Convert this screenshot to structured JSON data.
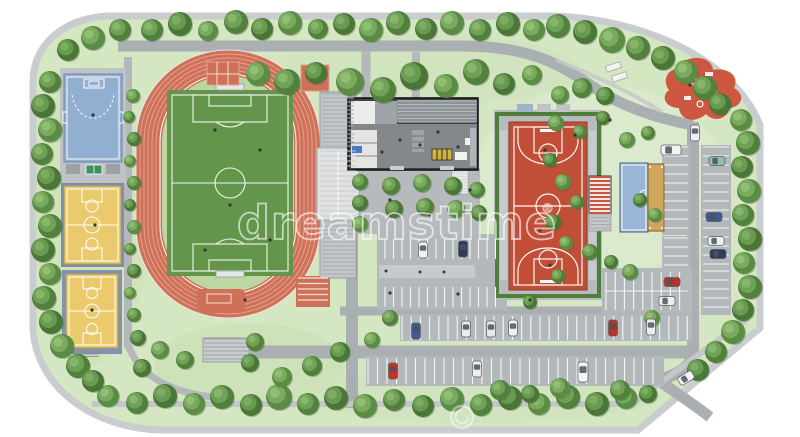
{
  "watermark": {
    "text": "dreamstime",
    "registered": "®",
    "color": "rgba(255,255,255,0.6)"
  },
  "palette": {
    "page_bg": "#ffffff",
    "grass": "#d5e6c2",
    "grass_light": "#dcead0",
    "grass_dark": "#c9dfb4",
    "road": "#aaafb1",
    "path": "#b4b8ba",
    "parking": "#b3b8ba",
    "sidewalk": "#c9cdcf",
    "track_red": "#cf7058",
    "track_line": "#e2a290",
    "pitch_green": "#63964a",
    "court_blue": "#92aed0",
    "court_yellow": "#eaca6d",
    "court_red": "#c14f38",
    "sand": "#cfa75e",
    "building_dark": "#3f4347",
    "stand_gray": "#c2c6c8",
    "tree_green": "#5e9048",
    "playground_red": "#cd4f38",
    "white_line": "#ffffff"
  },
  "facilities": [
    "running-track",
    "soccer-field",
    "grandstand",
    "shot-put-area",
    "long-jump-lanes",
    "handball-court-blue",
    "basketball-court-yellow-1",
    "basketball-court-yellow-2",
    "table-tennis-table",
    "clubhouse-building",
    "bike-racks",
    "basketball-court-red",
    "east-pavilion",
    "multi-purpose-court-blue",
    "sand-court",
    "playground",
    "picnic-tables",
    "south-bleachers",
    "central-parking",
    "east-parking",
    "south-parking"
  ],
  "map": {
    "trees": [
      [
        152,
        30,
        11
      ],
      [
        180,
        24,
        12
      ],
      [
        208,
        31,
        10
      ],
      [
        236,
        22,
        12
      ],
      [
        262,
        29,
        11
      ],
      [
        290,
        23,
        12
      ],
      [
        318,
        29,
        10
      ],
      [
        344,
        24,
        11
      ],
      [
        371,
        30,
        12
      ],
      [
        398,
        23,
        12
      ],
      [
        426,
        29,
        11
      ],
      [
        452,
        23,
        12
      ],
      [
        480,
        30,
        11
      ],
      [
        508,
        24,
        12
      ],
      [
        534,
        30,
        11
      ],
      [
        558,
        26,
        12
      ],
      [
        585,
        32,
        12
      ],
      [
        612,
        40,
        13
      ],
      [
        638,
        48,
        12
      ],
      [
        663,
        58,
        12
      ],
      [
        686,
        72,
        12
      ],
      [
        705,
        88,
        12
      ],
      [
        720,
        104,
        11
      ],
      [
        741,
        120,
        11
      ],
      [
        748,
        143,
        12
      ],
      [
        742,
        167,
        11
      ],
      [
        749,
        191,
        12
      ],
      [
        743,
        215,
        11
      ],
      [
        750,
        239,
        12
      ],
      [
        744,
        263,
        11
      ],
      [
        750,
        287,
        12
      ],
      [
        743,
        310,
        11
      ],
      [
        733,
        332,
        12
      ],
      [
        716,
        352,
        11
      ],
      [
        698,
        370,
        11
      ],
      [
        108,
        396,
        11
      ],
      [
        137,
        403,
        11
      ],
      [
        165,
        396,
        12
      ],
      [
        194,
        404,
        11
      ],
      [
        222,
        397,
        12
      ],
      [
        251,
        405,
        11
      ],
      [
        279,
        397,
        13
      ],
      [
        308,
        404,
        11
      ],
      [
        336,
        398,
        12
      ],
      [
        365,
        406,
        12
      ],
      [
        394,
        400,
        11
      ],
      [
        423,
        406,
        11
      ],
      [
        452,
        399,
        12
      ],
      [
        481,
        405,
        11
      ],
      [
        510,
        398,
        12
      ],
      [
        539,
        404,
        11
      ],
      [
        568,
        397,
        12
      ],
      [
        597,
        404,
        12
      ],
      [
        626,
        398,
        11
      ],
      [
        50,
        82,
        11
      ],
      [
        43,
        106,
        12
      ],
      [
        50,
        130,
        12
      ],
      [
        42,
        154,
        11
      ],
      [
        49,
        178,
        12
      ],
      [
        43,
        202,
        11
      ],
      [
        50,
        226,
        12
      ],
      [
        43,
        250,
        12
      ],
      [
        50,
        274,
        11
      ],
      [
        44,
        298,
        12
      ],
      [
        51,
        322,
        12
      ],
      [
        62,
        346,
        12
      ],
      [
        78,
        366,
        12
      ],
      [
        93,
        381,
        11
      ],
      [
        133,
        96,
        7
      ],
      [
        129,
        117,
        6
      ],
      [
        134,
        139,
        7
      ],
      [
        130,
        161,
        6
      ],
      [
        134,
        183,
        7
      ],
      [
        130,
        205,
        6
      ],
      [
        134,
        227,
        7
      ],
      [
        130,
        249,
        6
      ],
      [
        134,
        271,
        7
      ],
      [
        130,
        293,
        6
      ],
      [
        134,
        315,
        7
      ],
      [
        138,
        338,
        8
      ],
      [
        93,
        38,
        12
      ],
      [
        120,
        30,
        11
      ],
      [
        68,
        50,
        11
      ],
      [
        258,
        74,
        12
      ],
      [
        287,
        82,
        13
      ],
      [
        316,
        73,
        11
      ],
      [
        350,
        82,
        14
      ],
      [
        383,
        90,
        13
      ],
      [
        414,
        76,
        14
      ],
      [
        446,
        86,
        12
      ],
      [
        476,
        72,
        13
      ],
      [
        504,
        84,
        11
      ],
      [
        532,
        75,
        10
      ],
      [
        360,
        182,
        8
      ],
      [
        360,
        203,
        8
      ],
      [
        360,
        224,
        8
      ],
      [
        391,
        186,
        9
      ],
      [
        394,
        209,
        9
      ],
      [
        422,
        183,
        9
      ],
      [
        425,
        207,
        9
      ],
      [
        453,
        186,
        9
      ],
      [
        456,
        209,
        9
      ],
      [
        477,
        190,
        8
      ],
      [
        479,
        213,
        8
      ],
      [
        560,
        95,
        9
      ],
      [
        582,
        88,
        10
      ],
      [
        605,
        96,
        9
      ],
      [
        556,
        123,
        8
      ],
      [
        580,
        132,
        7
      ],
      [
        603,
        118,
        7
      ],
      [
        627,
        140,
        8
      ],
      [
        648,
        133,
        7
      ],
      [
        550,
        160,
        7
      ],
      [
        563,
        182,
        8
      ],
      [
        577,
        202,
        7
      ],
      [
        553,
        222,
        8
      ],
      [
        566,
        243,
        7
      ],
      [
        590,
        252,
        8
      ],
      [
        611,
        262,
        7
      ],
      [
        630,
        272,
        8
      ],
      [
        558,
        276,
        7
      ],
      [
        640,
        200,
        7
      ],
      [
        655,
        215,
        7
      ],
      [
        390,
        318,
        8
      ],
      [
        530,
        302,
        7
      ],
      [
        652,
        318,
        8
      ],
      [
        255,
        342,
        9
      ],
      [
        250,
        363,
        9
      ],
      [
        282,
        377,
        10
      ],
      [
        312,
        366,
        10
      ],
      [
        340,
        352,
        10
      ],
      [
        372,
        340,
        8
      ],
      [
        500,
        390,
        10
      ],
      [
        530,
        394,
        9
      ],
      [
        560,
        388,
        10
      ],
      [
        620,
        390,
        10
      ],
      [
        648,
        394,
        9
      ],
      [
        160,
        350,
        9
      ],
      [
        185,
        360,
        9
      ],
      [
        142,
        368,
        9
      ]
    ],
    "cars": [
      {
        "x": 423,
        "y": 250,
        "c": "#f2f2f2",
        "o": "v"
      },
      {
        "x": 463,
        "y": 249,
        "c": "#2e3b5e",
        "o": "v"
      },
      {
        "x": 416,
        "y": 331,
        "c": "#3f5a96",
        "o": "v"
      },
      {
        "x": 466,
        "y": 329,
        "c": "#ececec",
        "o": "v"
      },
      {
        "x": 491,
        "y": 329,
        "c": "#e8e8e8",
        "o": "v"
      },
      {
        "x": 513,
        "y": 328,
        "c": "#f0f0f0",
        "o": "v"
      },
      {
        "x": 613,
        "y": 328,
        "c": "#c03028",
        "o": "v"
      },
      {
        "x": 651,
        "y": 327,
        "c": "#ededed",
        "o": "v"
      },
      {
        "x": 393,
        "y": 371,
        "c": "#c83028",
        "o": "v"
      },
      {
        "x": 477,
        "y": 369,
        "c": "#efefef",
        "o": "v"
      },
      {
        "x": 583,
        "y": 372,
        "c": "#f4f4f4",
        "o": "v",
        "van": true
      },
      {
        "x": 671,
        "y": 150,
        "c": "#f4f4f4",
        "o": "h",
        "van": true
      },
      {
        "x": 695,
        "y": 133,
        "c": "#f0f0f0",
        "o": "v"
      },
      {
        "x": 717,
        "y": 161,
        "c": "#8fbfae",
        "o": "h"
      },
      {
        "x": 714,
        "y": 217,
        "c": "#3f5a96",
        "o": "h"
      },
      {
        "x": 716,
        "y": 241,
        "c": "#f0f0f0",
        "o": "h"
      },
      {
        "x": 718,
        "y": 254,
        "c": "#2e3b5e",
        "o": "h"
      },
      {
        "x": 672,
        "y": 282,
        "c": "#c03028",
        "o": "h"
      },
      {
        "x": 667,
        "y": 301,
        "c": "#f0f0f0",
        "o": "h"
      },
      {
        "x": 686,
        "y": 378,
        "c": "#f2f2f2",
        "o": "h",
        "angle": -32
      }
    ],
    "people": [
      [
        215,
        130
      ],
      [
        260,
        150
      ],
      [
        230,
        205
      ],
      [
        205,
        250
      ],
      [
        270,
        240
      ],
      [
        245,
        300
      ],
      [
        93,
        115
      ],
      [
        95,
        225
      ],
      [
        92,
        310
      ],
      [
        545,
        150
      ],
      [
        540,
        230
      ],
      [
        550,
        265
      ],
      [
        390,
        200
      ],
      [
        430,
        215
      ],
      [
        470,
        190
      ],
      [
        390,
        293
      ],
      [
        458,
        294
      ],
      [
        530,
        300
      ],
      [
        400,
        140
      ],
      [
        420,
        145
      ],
      [
        438,
        132
      ],
      [
        382,
        152
      ],
      [
        458,
        147
      ],
      [
        690,
        85
      ],
      [
        610,
        120
      ],
      [
        575,
        135
      ]
    ],
    "hatches": [
      {
        "x": 322,
        "y": 94,
        "w": 32,
        "h": 52,
        "dir": "h",
        "gap": 4,
        "color": "#a6abad",
        "lw": 1
      },
      {
        "x": 320,
        "y": 151,
        "w": 36,
        "h": 66,
        "dir": "h",
        "gap": 5,
        "color": "#c9ccce",
        "lw": 1
      },
      {
        "x": 322,
        "y": 222,
        "w": 32,
        "h": 54,
        "dir": "h",
        "gap": 4,
        "color": "#a6abad",
        "lw": 1
      },
      {
        "x": 398,
        "y": 101,
        "w": 78,
        "h": 21,
        "dir": "h",
        "gap": 3.5,
        "color": "#b6bbbf",
        "lw": 1
      },
      {
        "x": 298,
        "y": 278,
        "w": 30,
        "h": 27,
        "dir": "h",
        "gap": 5.5,
        "color": "#f2ded8",
        "lw": 1.2
      },
      {
        "x": 204,
        "y": 339,
        "w": 44,
        "h": 22,
        "dir": "h",
        "gap": 4,
        "color": "#9fa3a5",
        "lw": 1
      },
      {
        "x": 385,
        "y": 239,
        "w": 118,
        "h": 20,
        "dir": "v",
        "gap": 8.5,
        "color": "#f6f6f6",
        "lw": 1.1
      },
      {
        "x": 385,
        "y": 287,
        "w": 118,
        "h": 20,
        "dir": "v",
        "gap": 8.5,
        "color": "#f6f6f6",
        "lw": 1.1
      },
      {
        "x": 606,
        "y": 272,
        "w": 82,
        "h": 38,
        "dir": "v",
        "gap": 9.2,
        "color": "#f6f6f6",
        "lw": 1.1
      },
      {
        "x": 402,
        "y": 316,
        "w": 286,
        "h": 24,
        "dir": "v",
        "gap": 9.2,
        "color": "#f6f6f6",
        "lw": 1.1
      },
      {
        "x": 368,
        "y": 358,
        "w": 292,
        "h": 26,
        "dir": "v",
        "gap": 9.5,
        "color": "#f6f6f6",
        "lw": 1.1
      },
      {
        "x": 664,
        "y": 147,
        "w": 24,
        "h": 86,
        "dir": "h",
        "gap": 9,
        "color": "#f6f6f6",
        "lw": 1.1
      },
      {
        "x": 703,
        "y": 147,
        "w": 26,
        "h": 120,
        "dir": "h",
        "gap": 9,
        "color": "#f6f6f6",
        "lw": 1.1
      },
      {
        "x": 664,
        "y": 238,
        "w": 24,
        "h": 34,
        "dir": "h",
        "gap": 9,
        "color": "#f6f6f6",
        "lw": 1.1
      },
      {
        "x": 703,
        "y": 271,
        "w": 26,
        "h": 42,
        "dir": "h",
        "gap": 9,
        "color": "#f6f6f6",
        "lw": 1.1
      },
      {
        "x": 452,
        "y": 172,
        "w": 16,
        "h": 22,
        "dir": "h",
        "gap": 3,
        "color": "#f4f4f4",
        "lw": 1
      },
      {
        "x": 590,
        "y": 214,
        "w": 20,
        "h": 16,
        "dir": "h",
        "gap": 3.5,
        "color": "#a6abad",
        "lw": 1
      },
      {
        "x": 590,
        "y": 177,
        "w": 20,
        "h": 36,
        "dir": "h",
        "gap": 4,
        "color": "#cd5440",
        "lw": 2
      },
      {
        "x": 73,
        "y": 349,
        "w": 26,
        "h": 8,
        "dir": "h",
        "gap": 2.5,
        "color": "#8e9294",
        "lw": 1
      }
    ]
  }
}
